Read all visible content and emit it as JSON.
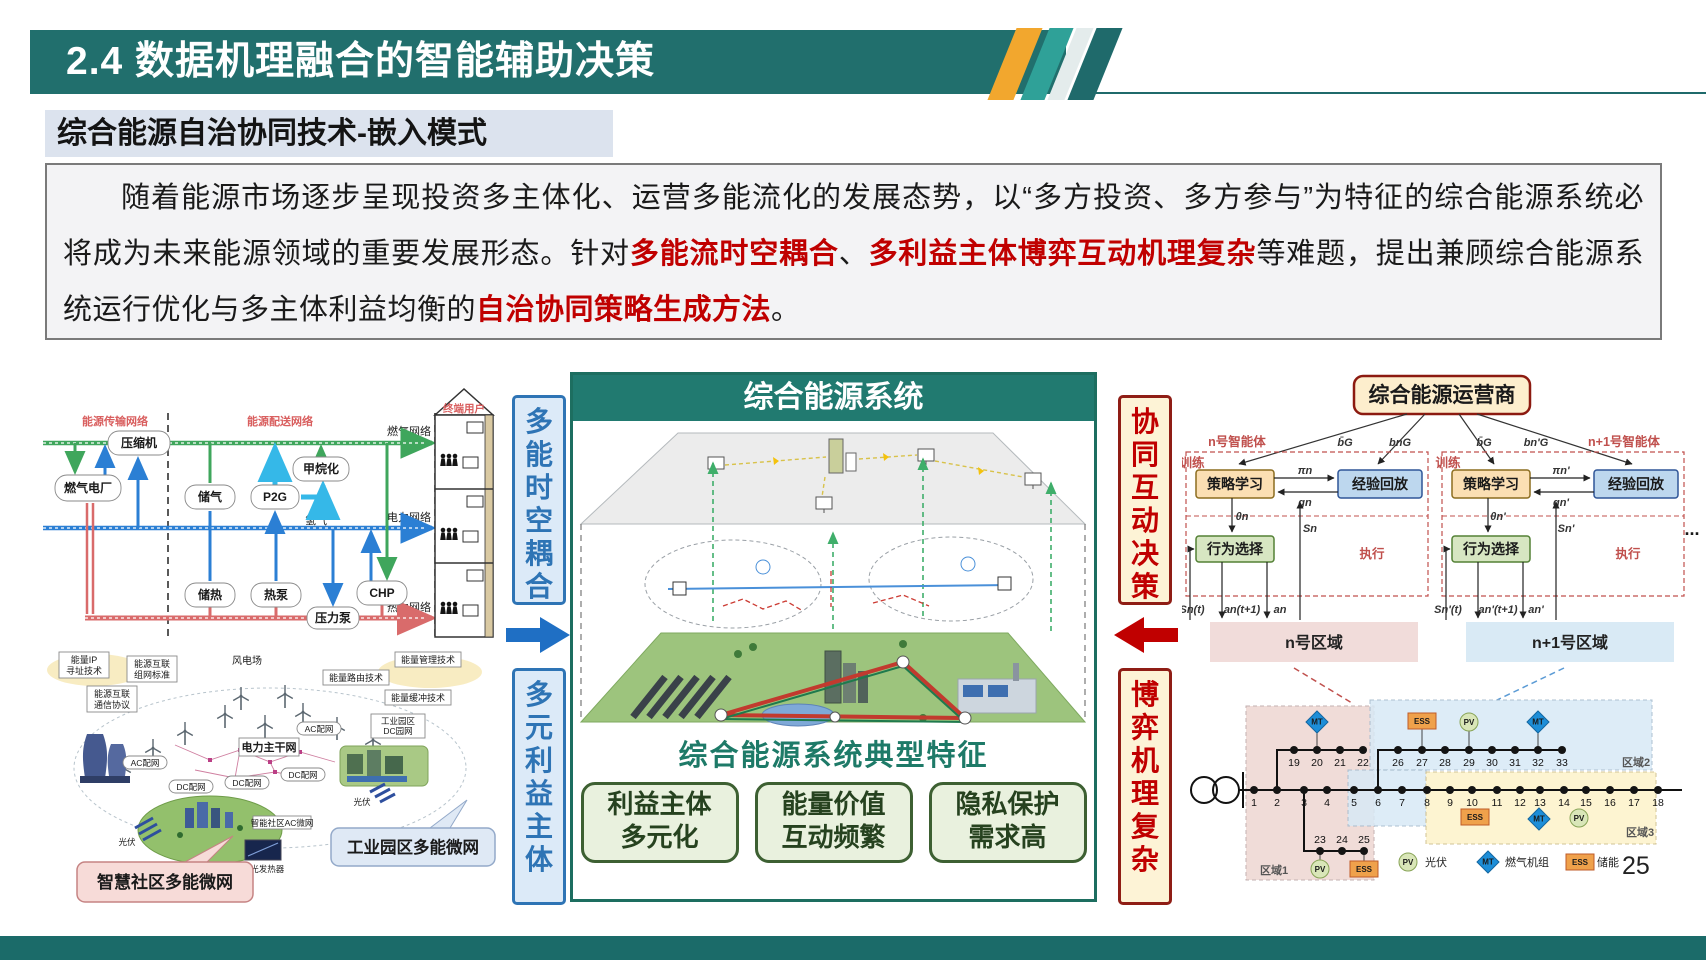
{
  "slide": {
    "title": "2.4 数据机理融合的智能辅助决策",
    "subtitle": "综合能源自治协同技术-嵌入模式",
    "page_number": "25"
  },
  "paragraph": {
    "segments": [
      {
        "text": "随着能源市场逐步呈现投资多主体化、运营多能流化的发展态势，以“多方投资、多方参与”为特征的综合能源系统必将成为未来能源领域的重要发展形态。针对",
        "red": false
      },
      {
        "text": "多能流时空耦合",
        "red": true
      },
      {
        "text": "、",
        "red": false
      },
      {
        "text": "多利益主体博弈互动机理复杂",
        "red": true
      },
      {
        "text": "等难题，提出兼顾综合能源系统运行优化与多主体利益均衡的",
        "red": false
      },
      {
        "text": "自治协同策略生成方法",
        "red": true
      },
      {
        "text": "。",
        "red": false
      }
    ]
  },
  "columns": {
    "left_top": "多能时空耦合",
    "left_bottom": "多元利益主体",
    "right_top": "协同互动决策",
    "right_bottom": "博弈机理复杂"
  },
  "left_flow": {
    "labels": {
      "transmission": "能源传输网络",
      "distribution": "能源配送网络",
      "gas_net": "燃气网络",
      "power_net": "电力网络",
      "heat_net": "热力网络",
      "hydrogen": "氢气",
      "end_user": "终端用户"
    },
    "boxes": {
      "compressor": "压缩机",
      "gas_plant": "燃气电厂",
      "gas_storage": "储气",
      "p2g": "P2G",
      "methanation": "甲烷化",
      "heat_storage": "储热",
      "heat_pump": "热泵",
      "chp": "CHP",
      "pressure_pump": "压力泵"
    }
  },
  "left_picture": {
    "tech": [
      {
        "l1": "能量IP",
        "l2": "寻址技术"
      },
      {
        "l1": "能源互联",
        "l2": "组网标准"
      },
      {
        "l1": "能源互联",
        "l2": "通信协议"
      },
      {
        "l1": "能量管理技术"
      },
      {
        "l1": "能量路由技术"
      },
      {
        "l1": "能量缓冲技术"
      }
    ],
    "wind_farm": "风电场",
    "backbone": "电力主干网",
    "grids": [
      "AC配网",
      "DC配网",
      "DC配网",
      "DC配网",
      "AC配网"
    ],
    "park": {
      "l1": "工业园区",
      "l2": "DC园网"
    },
    "community_grid": "智能社区AC微网",
    "csp": "聚光发热器",
    "pv_label": "光伏",
    "callout_community": "智慧社区多能微网",
    "callout_industry": "工业园区多能微网"
  },
  "center_panel": {
    "header": "综合能源系统",
    "caption": "综合能源系统典型特征",
    "features": [
      {
        "l1": "利益主体",
        "l2": "多元化"
      },
      {
        "l1": "能量价值",
        "l2": "互动频繁"
      },
      {
        "l1": "隐私保护",
        "l2": "需求高"
      }
    ]
  },
  "right_panel": {
    "operator": "综合能源运营商",
    "ellipsis": "...",
    "agents": [
      {
        "name": "n号智能体",
        "train": "训练",
        "policy": "策略学习",
        "replay": "经验回放",
        "action": "行为选择",
        "exec": "执行",
        "region": "n号区域",
        "math": {
          "b_bar": "b̄G",
          "b": "bnG",
          "pi": "πn",
          "g": "gn",
          "theta": "θn",
          "S": "Sn",
          "St": "Sn(t)",
          "at": "an(t+1)",
          "a": "an"
        }
      },
      {
        "name": "n+1号智能体",
        "train": "训练",
        "policy": "策略学习",
        "replay": "经验回放",
        "action": "行为选择",
        "exec": "执行",
        "region": "n+1号区域",
        "math": {
          "b_bar": "b̄G",
          "b": "bn'G",
          "pi": "πn'",
          "g": "gn'",
          "theta": "θn'",
          "S": "Sn'",
          "St": "Sn'(t)",
          "at": "an'(t+1)",
          "a": "an'"
        }
      }
    ],
    "bus_network": {
      "region_labels": [
        "区域1",
        "区域2",
        "区域3"
      ],
      "device_labels": {
        "pv": "PV",
        "mt": "MT",
        "ess": "ESS"
      },
      "node_groups": [
        {
          "y": 420,
          "dy": 16,
          "xs": [
            72,
            95,
            122,
            145,
            172,
            196,
            220,
            245,
            268,
            290,
            315,
            338,
            358,
            382,
            404,
            428,
            452,
            476
          ],
          "labels": [
            "1",
            "2",
            "3",
            "4",
            "5",
            "6",
            "7",
            "8",
            "9",
            "10",
            "11",
            "12",
            "13",
            "14",
            "15",
            "16",
            "17",
            "18"
          ]
        },
        {
          "y": 380,
          "dy": 16,
          "xs": [
            112,
            135,
            158,
            181
          ],
          "labels": [
            "19",
            "20",
            "21",
            "22"
          ]
        },
        {
          "y": 380,
          "dy": 16,
          "xs": [
            216,
            240,
            263,
            287,
            310,
            333,
            356,
            380
          ],
          "labels": [
            "26",
            "27",
            "28",
            "29",
            "30",
            "31",
            "32",
            "33"
          ]
        },
        {
          "y": 481,
          "dy": -8,
          "xs": [
            138,
            160,
            182
          ],
          "labels": [
            "23",
            "24",
            "25"
          ]
        }
      ],
      "devices": [
        {
          "type": "mt",
          "x": 135,
          "y": 352,
          "stub": 380
        },
        {
          "type": "ess",
          "x": 240,
          "y": 351,
          "stub": 380
        },
        {
          "type": "pv",
          "x": 287,
          "y": 352,
          "stub": 380
        },
        {
          "type": "mt",
          "x": 356,
          "y": 352,
          "stub": 380
        },
        {
          "type": "ess",
          "x": 293,
          "y": 447
        },
        {
          "type": "mt",
          "x": 357,
          "y": 449
        },
        {
          "type": "pv",
          "x": 397,
          "y": 448
        },
        {
          "type": "pv",
          "x": 138,
          "y": 499,
          "stub": 481
        },
        {
          "type": "ess",
          "x": 182,
          "y": 499,
          "stub": 481
        }
      ],
      "legend": [
        {
          "type": "pv",
          "label": "光伏"
        },
        {
          "type": "mt",
          "label": "燃气机组"
        },
        {
          "type": "ess",
          "label": "储能"
        }
      ]
    }
  }
}
